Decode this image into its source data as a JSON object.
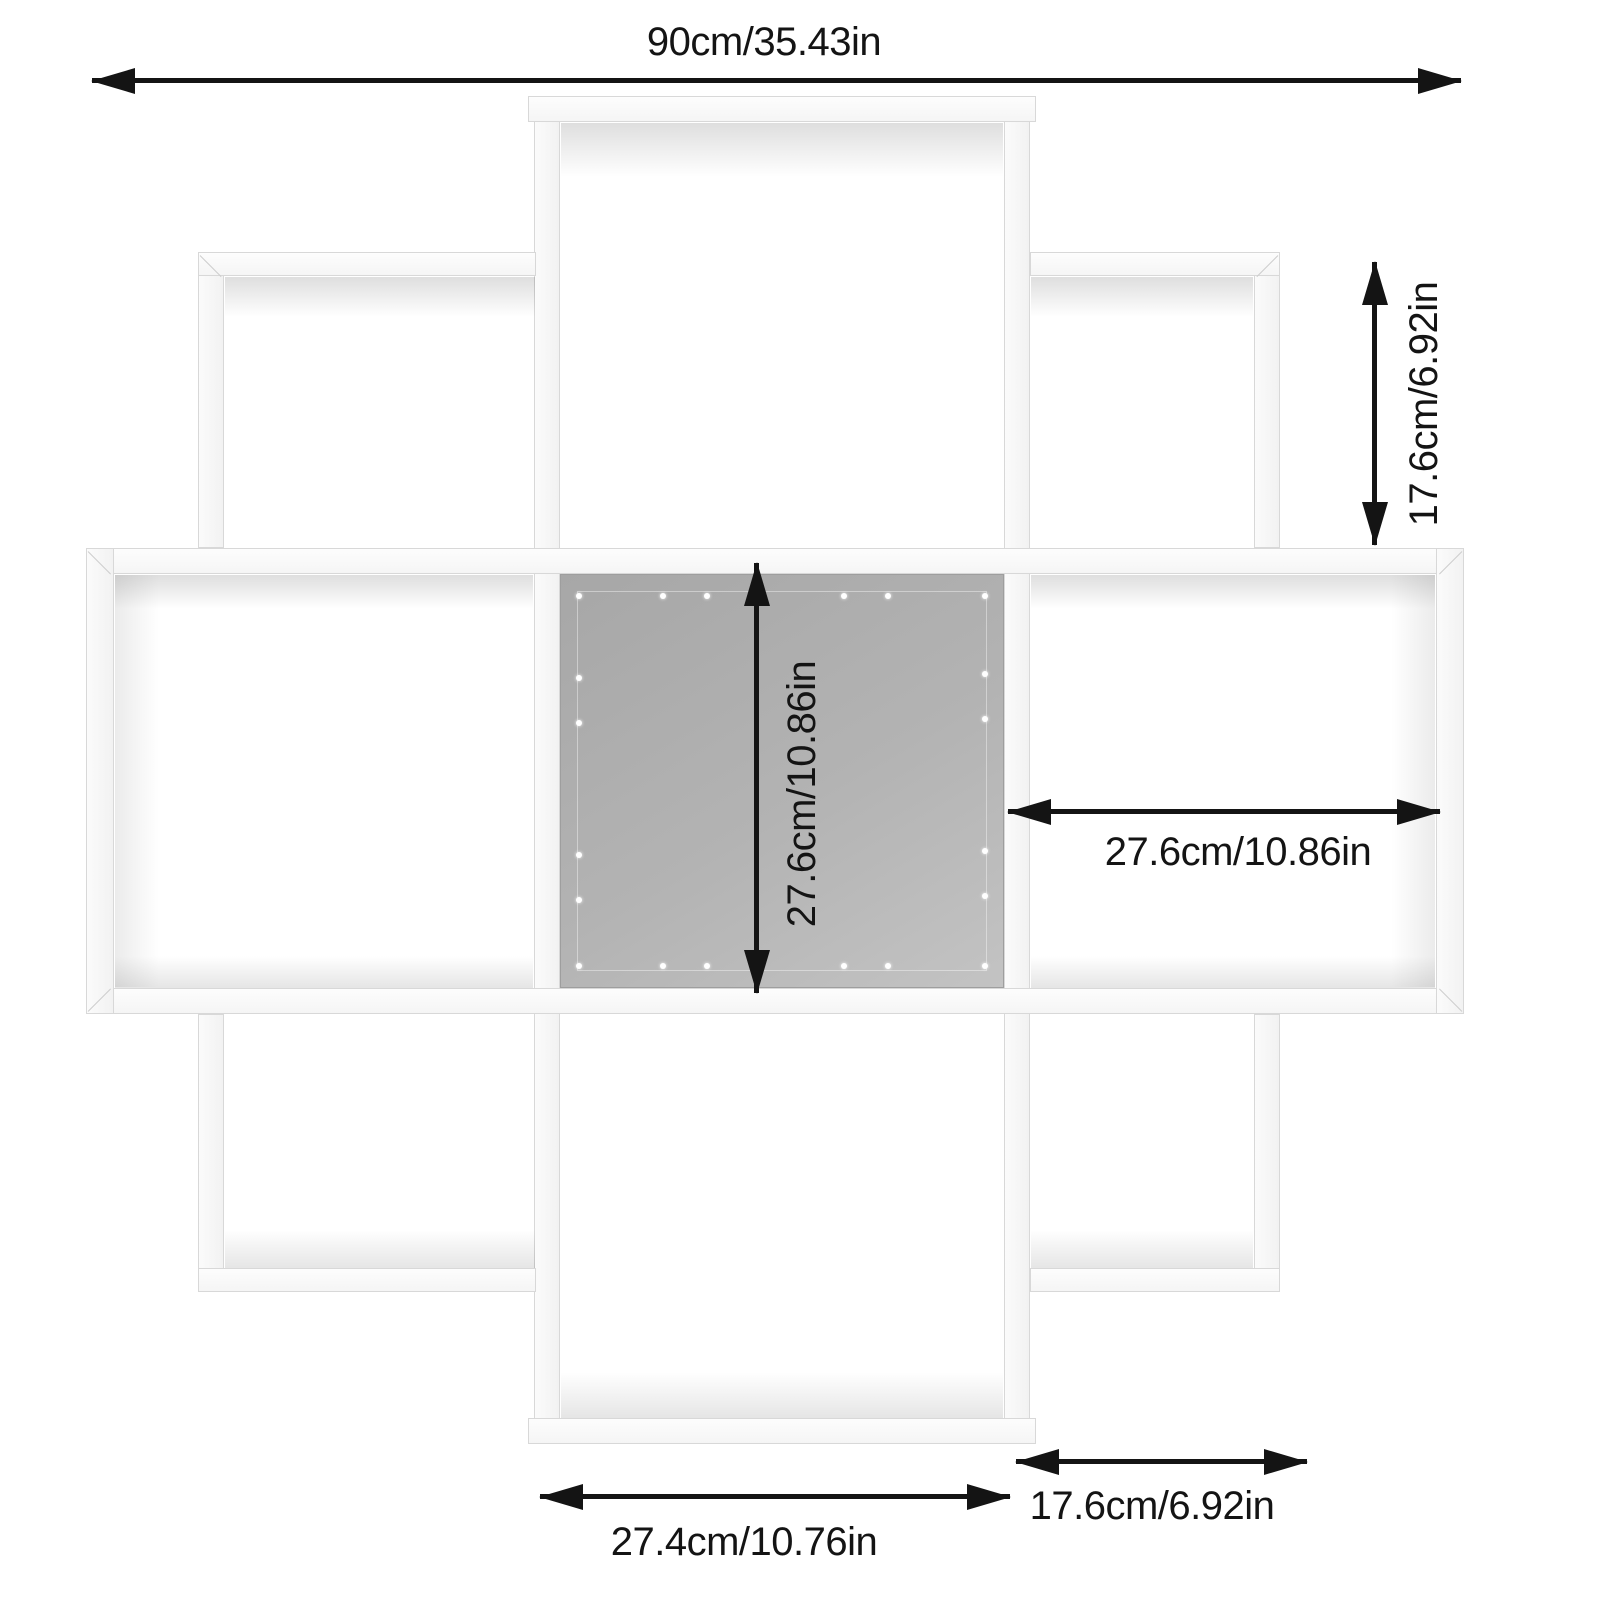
{
  "page": {
    "background": "#ffffff"
  },
  "diagram": {
    "title": "wall-mounted cube shelf dimension diagram",
    "colors": {
      "ink": "#141414",
      "back_panel_dark": "#a7a7a7",
      "back_panel_light": "#c3c3c3",
      "panel_white": "#fbfbfb",
      "panel_edge": "#d8d8d8"
    },
    "annotations": {
      "overall_width": "90cm/35.43in",
      "corner_cube_height": "17.6cm/6.92in",
      "center_cube_height": "27.6cm/10.86in",
      "middle_right_cube_width": "27.6cm/10.86in",
      "bottom_cube_width": "27.4cm/10.76in",
      "corner_cube_width": "17.6cm/6.92in"
    },
    "back_panel": {
      "holes": [
        {
          "x": 4,
          "y": 5
        },
        {
          "x": 96,
          "y": 5
        },
        {
          "x": 4,
          "y": 95
        },
        {
          "x": 96,
          "y": 95
        },
        {
          "x": 23,
          "y": 5
        },
        {
          "x": 33,
          "y": 5
        },
        {
          "x": 64,
          "y": 5
        },
        {
          "x": 74,
          "y": 5
        },
        {
          "x": 23,
          "y": 95
        },
        {
          "x": 33,
          "y": 95
        },
        {
          "x": 64,
          "y": 95
        },
        {
          "x": 74,
          "y": 95
        },
        {
          "x": 4,
          "y": 25
        },
        {
          "x": 4,
          "y": 36
        },
        {
          "x": 4,
          "y": 68
        },
        {
          "x": 4,
          "y": 79
        },
        {
          "x": 96,
          "y": 24
        },
        {
          "x": 96,
          "y": 35
        },
        {
          "x": 96,
          "y": 67
        },
        {
          "x": 96,
          "y": 78
        }
      ]
    }
  }
}
